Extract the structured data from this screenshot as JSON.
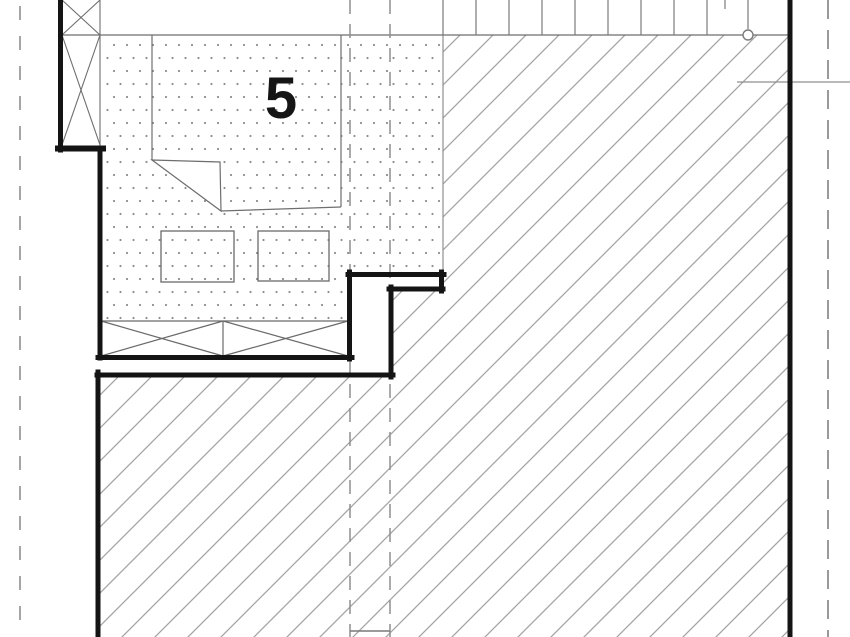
{
  "drawing": {
    "title": "floor-plan-detail",
    "room_label": "5",
    "colors": {
      "background": "#ffffff",
      "wall": "#141414",
      "outline": "#6e6e6e",
      "hatch_line": "#a4a4a4",
      "dot": "#8f8f8f",
      "dashed_line": "#8f8f8f"
    },
    "symbols": {
      "dotted_fill": "dot-hatch-floor-finish",
      "diagonal_fill": "diagonal-hatch-slab",
      "x_braces": "wall-insulation-x-symbol",
      "circle_marker": "survey-point-circle"
    }
  }
}
